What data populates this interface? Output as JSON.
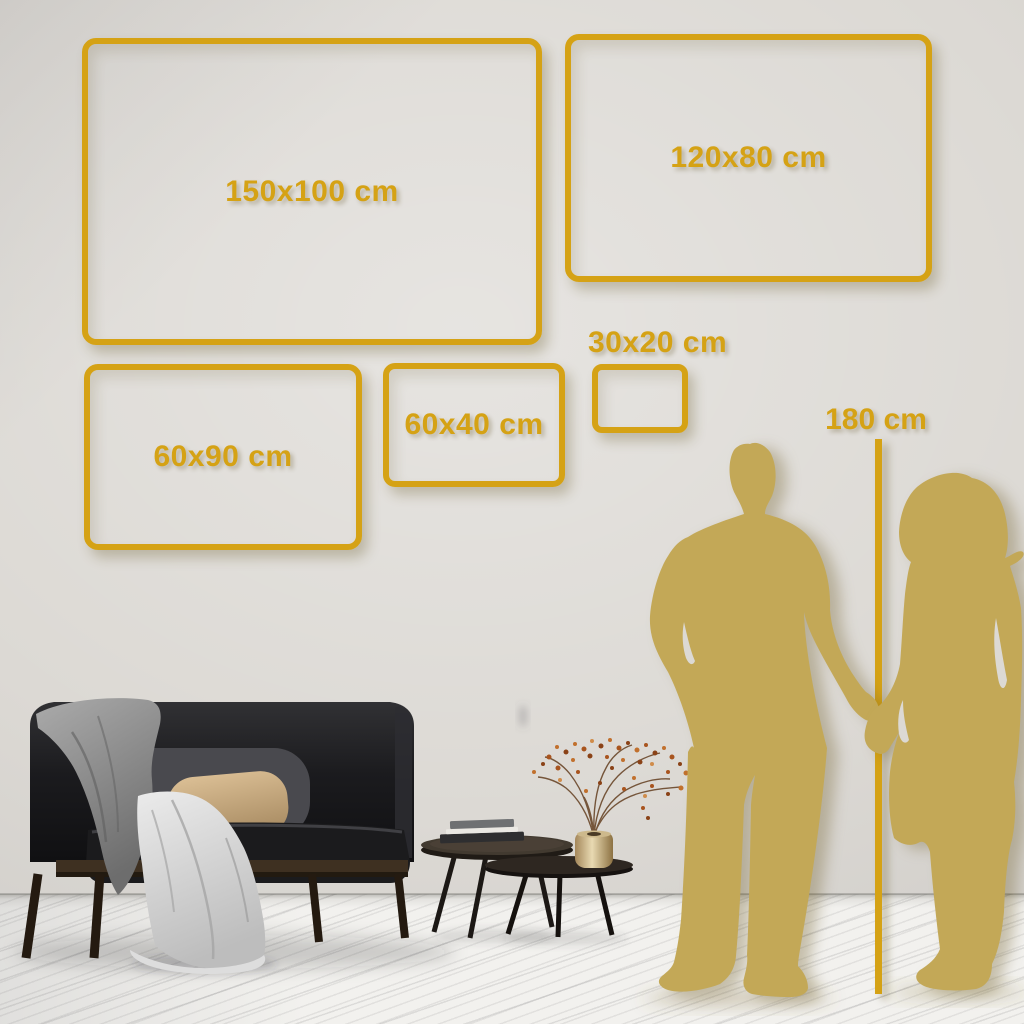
{
  "sizes": [
    {
      "id": "150x100",
      "label": "150x100 cm"
    },
    {
      "id": "120x80",
      "label": "120x80 cm"
    },
    {
      "id": "60x90",
      "label": "60x90 cm"
    },
    {
      "id": "60x40",
      "label": "60x40 cm"
    },
    {
      "id": "30x20",
      "label": "30x20 cm"
    }
  ],
  "height_reference": {
    "label": "180 cm"
  },
  "colors": {
    "accent_gold": "#D5A215",
    "silhouette_gold": "#C3A857",
    "wall": "#DCD9D4",
    "floor": "#F2F1EE"
  },
  "figures": [
    {
      "name": "man-silhouette"
    },
    {
      "name": "woman-silhouette"
    }
  ]
}
